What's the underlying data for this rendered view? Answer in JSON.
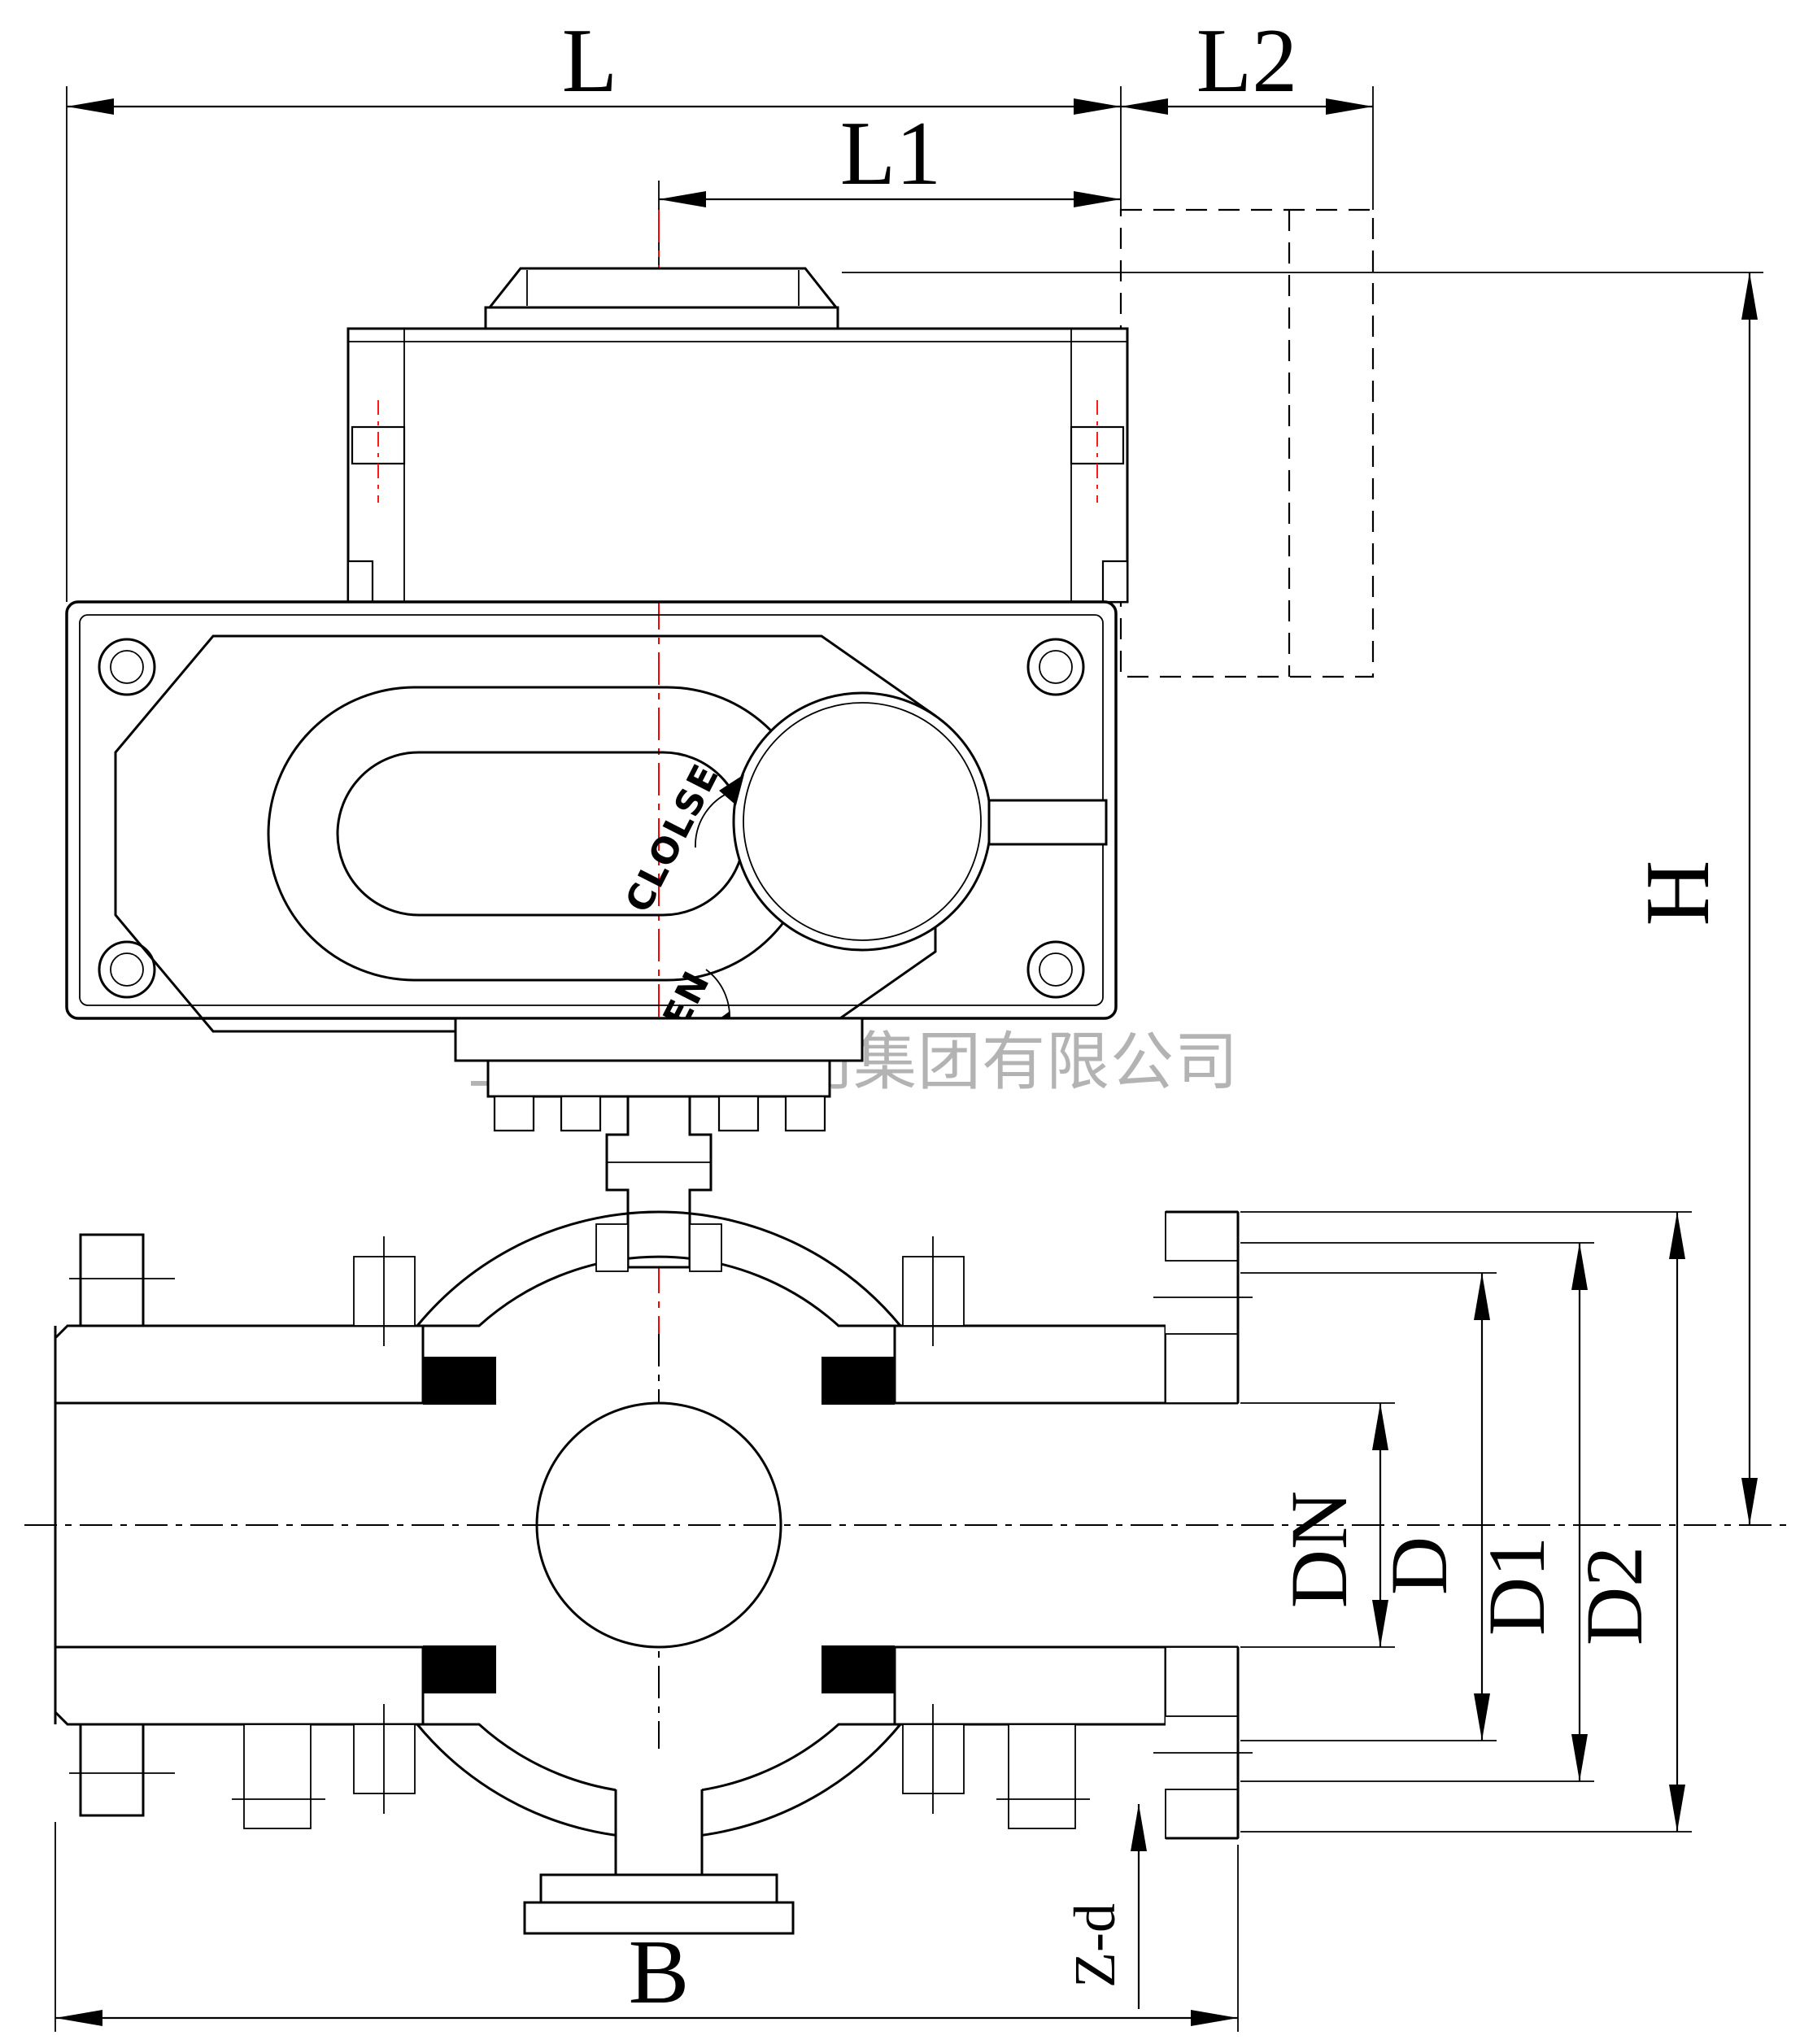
{
  "watermark": "上海湖泉阀门集团有限公司",
  "dimension_labels": {
    "overall_length": "L",
    "center_to_end": "L1",
    "side_extension": "L2",
    "height": "H",
    "body_length": "B",
    "nominal_bore": "DN",
    "diameter": "D",
    "diameter_1": "D1",
    "diameter_2": "D2",
    "bolt_holes": "Z-d"
  },
  "actuator_dial": {
    "close_label": "CLOLSE",
    "open_label": "OPEN"
  },
  "colors": {
    "line": "#000000",
    "centerline_red": "#ff0000",
    "watermark_gray": "#b3b3b3",
    "seat_black": "#000000",
    "background": "#ffffff"
  }
}
